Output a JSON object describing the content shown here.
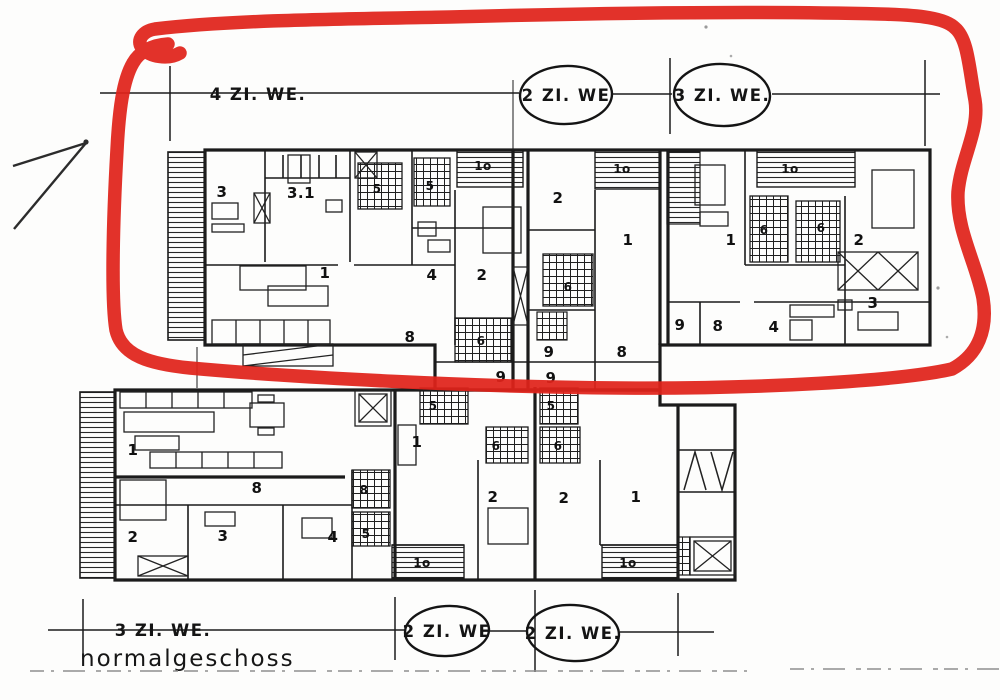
{
  "caption": "normalgeschoss",
  "dimension_labels": {
    "top": [
      {
        "text": "4 ZI. WE.",
        "circled": false
      },
      {
        "text": "2 ZI. WE",
        "circled": true
      },
      {
        "text": "3 ZI. WE.",
        "circled": true
      }
    ],
    "bottom": [
      {
        "text": "3 ZI. WE.",
        "circled": false
      },
      {
        "text": "2 ZI. WE",
        "circled": true
      },
      {
        "text": "2 ZI. WE.",
        "circled": true
      }
    ]
  },
  "annotation": {
    "type": "hand-drawn red marker loop around upper floor plan",
    "color": "#e0221a",
    "arrow": "pencil arrow pointing to circled plan from lower left"
  },
  "upper_plan": {
    "description": "upper floor plan (circled in red)",
    "room_labels": [
      {
        "t": "3",
        "x": 222,
        "y": 197
      },
      {
        "t": "3.1",
        "x": 301,
        "y": 198
      },
      {
        "t": "5",
        "x": 377,
        "y": 193,
        "s": 1
      },
      {
        "t": "5",
        "x": 430,
        "y": 190,
        "s": 1
      },
      {
        "t": "1o",
        "x": 483,
        "y": 170,
        "s": 1
      },
      {
        "t": "1o",
        "x": 622,
        "y": 173,
        "s": 1
      },
      {
        "t": "1o",
        "x": 790,
        "y": 173,
        "s": 1
      },
      {
        "t": "1",
        "x": 325,
        "y": 278
      },
      {
        "t": "4",
        "x": 432,
        "y": 280
      },
      {
        "t": "2",
        "x": 482,
        "y": 280
      },
      {
        "t": "2",
        "x": 558,
        "y": 203
      },
      {
        "t": "1",
        "x": 628,
        "y": 245
      },
      {
        "t": "6",
        "x": 568,
        "y": 291,
        "s": 1
      },
      {
        "t": "8",
        "x": 410,
        "y": 342
      },
      {
        "t": "6",
        "x": 481,
        "y": 345,
        "s": 1
      },
      {
        "t": "9",
        "x": 549,
        "y": 357
      },
      {
        "t": "8",
        "x": 622,
        "y": 357
      },
      {
        "t": "9",
        "x": 501,
        "y": 382
      },
      {
        "t": "9",
        "x": 551,
        "y": 383
      },
      {
        "t": "9",
        "x": 680,
        "y": 330
      },
      {
        "t": "8",
        "x": 718,
        "y": 331
      },
      {
        "t": "4",
        "x": 774,
        "y": 332
      },
      {
        "t": "1",
        "x": 731,
        "y": 245
      },
      {
        "t": "6",
        "x": 764,
        "y": 234,
        "s": 1
      },
      {
        "t": "6",
        "x": 821,
        "y": 232,
        "s": 1
      },
      {
        "t": "2",
        "x": 859,
        "y": 245
      },
      {
        "t": "3",
        "x": 873,
        "y": 308
      }
    ]
  },
  "lower_plan": {
    "description": "lower floor plan",
    "room_labels": [
      {
        "t": "1",
        "x": 133,
        "y": 455
      },
      {
        "t": "8",
        "x": 257,
        "y": 493
      },
      {
        "t": "2",
        "x": 133,
        "y": 542
      },
      {
        "t": "3",
        "x": 223,
        "y": 541
      },
      {
        "t": "4",
        "x": 333,
        "y": 542
      },
      {
        "t": "8",
        "x": 364,
        "y": 494,
        "s": 1
      },
      {
        "t": "5",
        "x": 366,
        "y": 538,
        "s": 1
      },
      {
        "t": "1",
        "x": 417,
        "y": 447
      },
      {
        "t": "5",
        "x": 433,
        "y": 410,
        "s": 1
      },
      {
        "t": "6",
        "x": 496,
        "y": 450,
        "s": 1
      },
      {
        "t": "2",
        "x": 493,
        "y": 502
      },
      {
        "t": "1o",
        "x": 422,
        "y": 567,
        "s": 1
      },
      {
        "t": "5",
        "x": 551,
        "y": 410,
        "s": 1
      },
      {
        "t": "6",
        "x": 558,
        "y": 450,
        "s": 1
      },
      {
        "t": "2",
        "x": 564,
        "y": 503
      },
      {
        "t": "1",
        "x": 636,
        "y": 502
      },
      {
        "t": "1o",
        "x": 628,
        "y": 567,
        "s": 1
      }
    ]
  }
}
